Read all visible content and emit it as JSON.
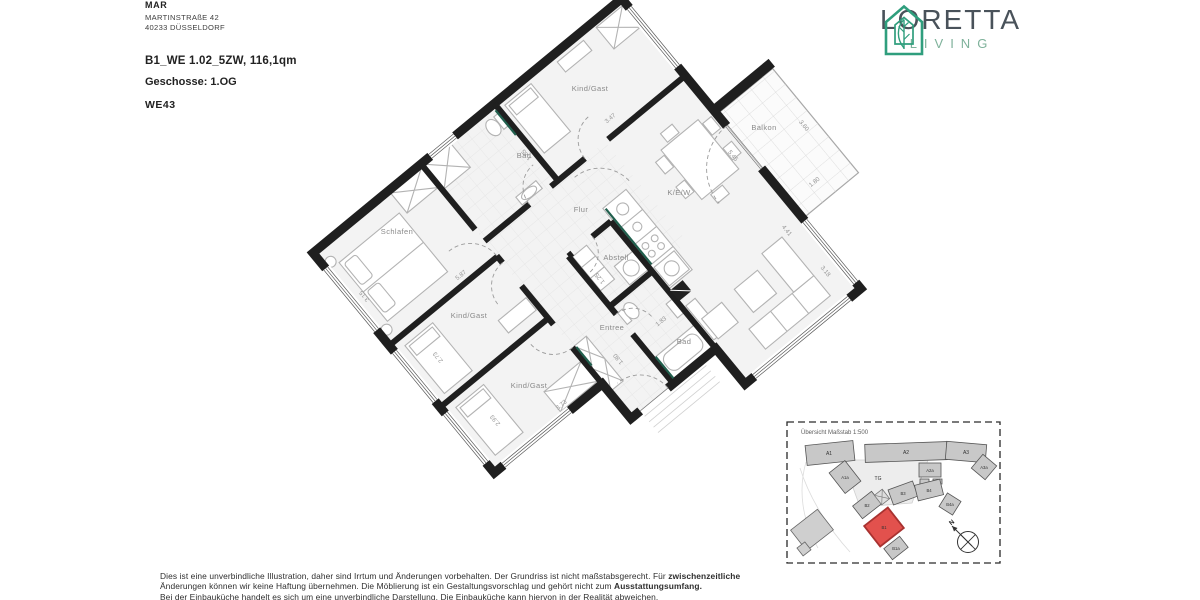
{
  "header": {
    "company": "MAR",
    "address_line1": "MARTINSTRAßE 42",
    "address_line2": "40233 DÜSSELDORF",
    "unit_title": "B1_WE 1.02_5ZW, 116,1qm",
    "floor_label": "Geschosse: 1.OG",
    "unit_code": "WE43"
  },
  "logo": {
    "name": "LORETTA",
    "subtitle": "LIVING"
  },
  "colors": {
    "brand_green": "#2f9e7d",
    "logo_text": "#49525a",
    "logo_sub": "#7fb29b",
    "wall": "#1f1f1f",
    "accent_teal": "#215f4d",
    "highlight_red": "#e2514d",
    "room_fill": "#f3f3f3",
    "label_gray": "#8a8a8a"
  },
  "floorplan": {
    "rooms": {
      "schlafen": "Schlafen",
      "bad_top": "Bad",
      "kind_gast_top": "Kind/Gast",
      "flur": "Flur",
      "kew": "K/E/W",
      "abstell": "Abstell",
      "kind_gast_mid": "Kind/Gast",
      "kind_gast_bottom": "Kind/Gast",
      "entree": "Entree",
      "bad_bottom": "Bad",
      "balkon": "Balkon"
    },
    "dimensions": {
      "top_kg_width": "3.47",
      "bad_depth": "1.85",
      "schlafen_width": "5.87",
      "schlafen_depth": "3.15",
      "kg_mid_depth": "2.73",
      "kg_bottom_depth": "2.93",
      "kg_bottom_width": "3.73",
      "abstell_width": "1.25",
      "bad_bottom_width": "1.83",
      "entree_width": "1.80",
      "kew_window_a": "5.45",
      "kew_window_b": "4.41",
      "kew_window_c": "3.18",
      "balkon_length": "3.60",
      "balkon_depth": "1.80"
    }
  },
  "inset": {
    "title": "Übersicht Maßstab 1:500",
    "north_label": "N",
    "buildings": {
      "a1": "A1",
      "a1a": "A1a",
      "a2": "A2",
      "a2a": "A2a",
      "a3": "A3",
      "a3a": "A3a",
      "tg": "TG",
      "b1": "B1",
      "b1a": "B1a",
      "b2": "B2",
      "b3": "B3",
      "b4": "B4",
      "b4a": "B4a"
    }
  },
  "disclaimer": {
    "line1_normal": "Dies ist eine unverbindliche Illustration, daher sind Irrtum und Änderungen vorbehalten. Der Grundriss ist nicht maßstabsgerecht. Für ",
    "line1_bold": "zwischenzeitliche",
    "line2_normal": "Änderungen können wir keine Haftung übernehmen. Die Möblierung ist ein Gestaltungsvorschlag und gehört nicht zum ",
    "line2_bold": "Ausstattungsumfang.",
    "line3": "Bei der Einbauküche handelt es sich um eine unverbindliche Darstellung. Die Einbauküche kann hiervon in der Realität abweichen."
  }
}
